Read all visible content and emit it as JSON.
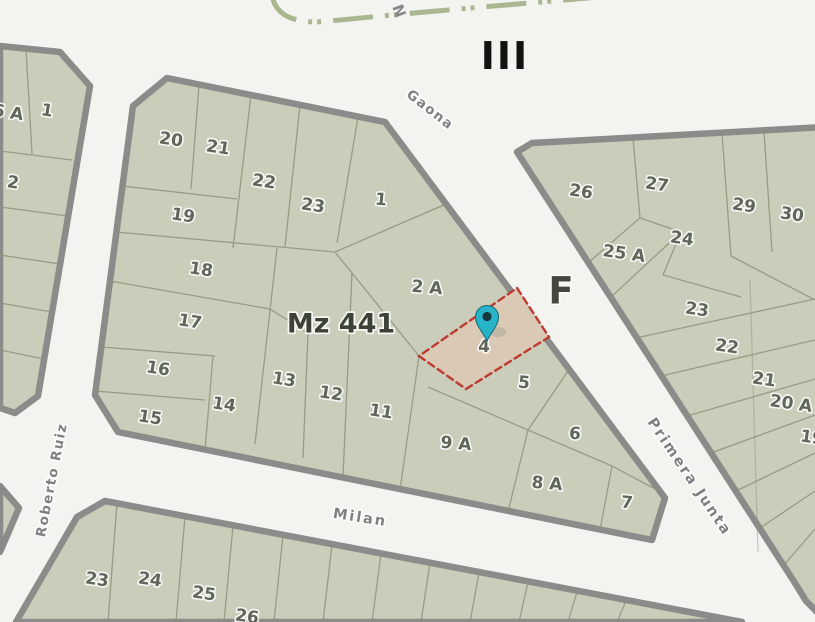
{
  "map": {
    "annotations": {
      "zone": "III",
      "section": "F",
      "north_partial": "N"
    },
    "streets": {
      "gaona": "Gaona",
      "primera_junta": "Primera Junta",
      "milan": "Milan",
      "roberto_ruiz": "Roberto Ruiz"
    },
    "selected_parcel": {
      "label": "4",
      "outline_color": "#bf3a31",
      "fill_color": "#d9c9b5",
      "marker_color": "#28b4c8"
    },
    "blocks": {
      "left": {
        "parcel_labels": [
          "6 A",
          "1",
          "2"
        ]
      },
      "middle": {
        "title": "Mz 441",
        "parcel_labels": [
          "20",
          "21",
          "22",
          "23",
          "1",
          "19",
          "18",
          "2 A",
          "17",
          "16",
          "15",
          "14",
          "13",
          "12",
          "11",
          "5",
          "9 A",
          "6",
          "8 A",
          "7"
        ]
      },
      "right": {
        "parcel_labels": [
          "26",
          "27",
          "25 A",
          "24",
          "29",
          "30",
          "23",
          "22",
          "21",
          "20 A",
          "19"
        ]
      },
      "bottom": {
        "parcel_labels": [
          "23",
          "24",
          "25",
          "26"
        ]
      }
    },
    "colors": {
      "street_bg": "#f3f3f0",
      "parcel_fill": "#c9cdb9",
      "block_border": "#8b8b89",
      "parcel_line": "#8a9079",
      "railway": "#a9b790"
    }
  }
}
